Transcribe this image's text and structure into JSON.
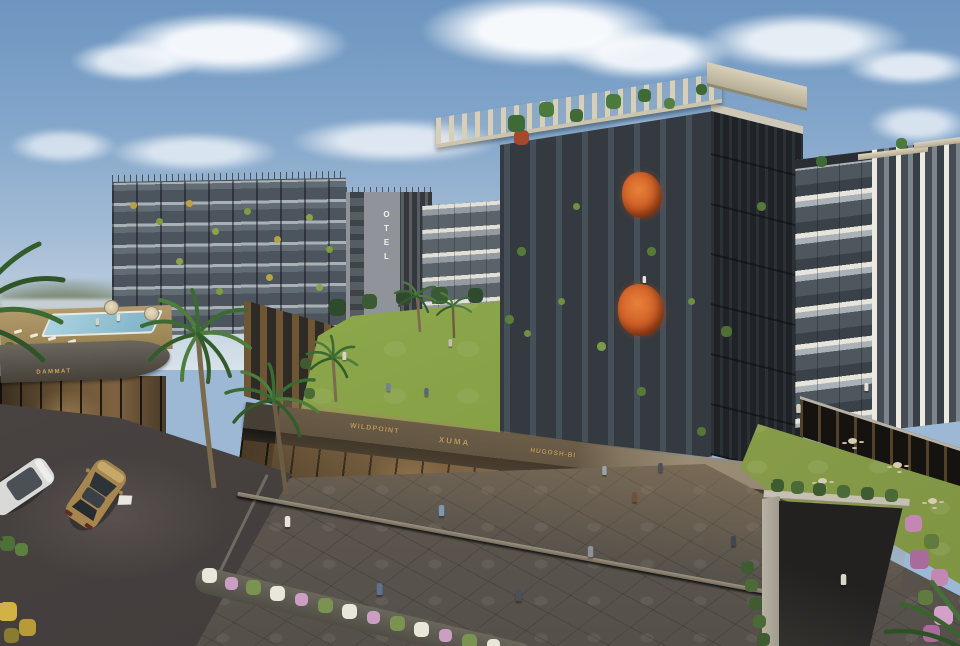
{
  "scene": {
    "title": "Aerial architectural rendering of a modern mixed-use residential complex",
    "time_of_day": "daytime",
    "sky": "blue sky with scattered cumulus clouds",
    "elements": "dark apartment blocks with glass balconies, hotel tower, rooftop pool deck, central courtyard lawn, palm trees, stone plaza with pedestrians, street with cars, cafe lawn, underground parking ramp"
  },
  "signs": {
    "hotel": "OTEL",
    "podium_shop": "DAMMAT",
    "shop_1": "WILDPOINT",
    "shop_2": "XUMA",
    "shop_3": "HUGOSH-BI"
  },
  "palette": {
    "sky_top": "#6d95c0",
    "sky_horizon": "#d8e2e9",
    "building_dark": "#343a40",
    "building_light_band": "#e7e4dc",
    "lawn_green": "#8aa449",
    "plaza_stone": "#655d52",
    "asphalt": "#474140",
    "sign_gold": "#c9a25e",
    "orange_tree": "#c6531f",
    "flower_pink": "#cd9ec4",
    "pool_blue": "#8fbccd"
  }
}
